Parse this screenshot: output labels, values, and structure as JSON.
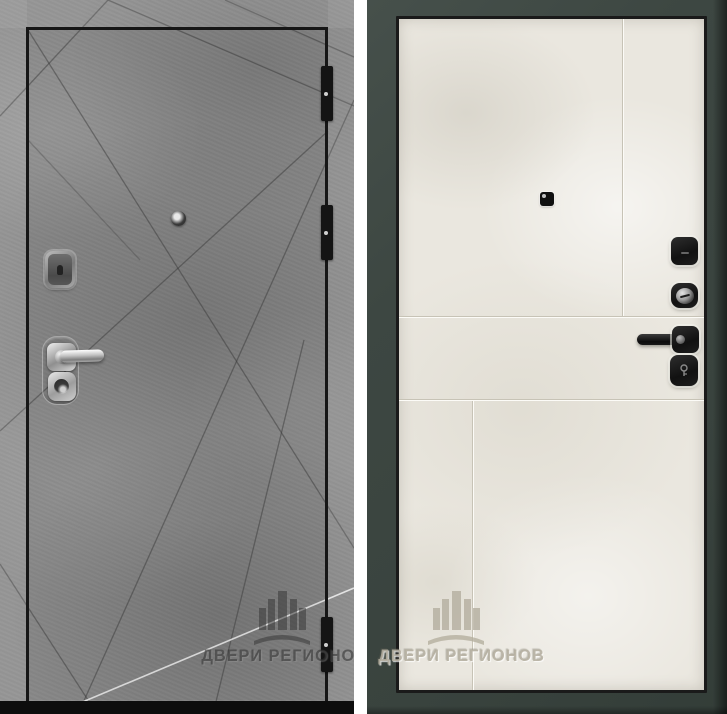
{
  "photo": {
    "subject": "steel entry door, front and back leaf views",
    "views": [
      {
        "id": "front",
        "finish": "gray concrete with diagonal ray grooves",
        "hardware": [
          "peephole",
          "upper-lock-escutcheon",
          "chrome-lever-handle",
          "cylinder-lock"
        ],
        "hinges": 3
      },
      {
        "id": "back",
        "finish": "cream panel in dark slate frame",
        "hardware": [
          "peephole",
          "upper-lock-escutcheon",
          "thumbturn-knob",
          "black-lever-handle",
          "cylinder-escutcheon"
        ]
      }
    ]
  },
  "watermark": {
    "text": "ДВЕРИ РЕГИОНОВ"
  },
  "colors": {
    "concrete_gray": "#8e8e8e",
    "leaf_outline": "#161616",
    "frame_slate": "#3d4742",
    "panel_cream": "#eae7df",
    "chrome": "#c6c6c6",
    "black_hardware": "#1a1a1a",
    "divider_white": "#ffffff"
  }
}
